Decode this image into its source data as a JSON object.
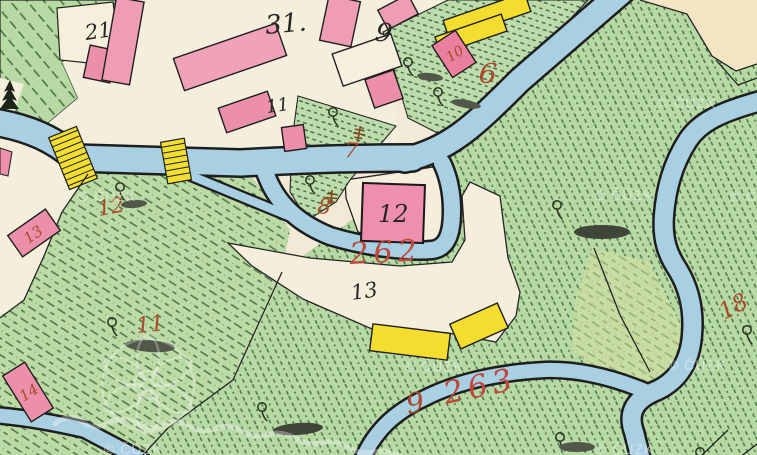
{
  "watermark": {
    "copyright": "© ČÚZK"
  },
  "palette": {
    "paper": "#f2ead6",
    "parcel_white": "#f4eedd",
    "beige_road": "#f3e5c4",
    "meadow_green": "#b7d9a4",
    "hatch_green": "#48744b",
    "water_blue": "#a9cfe2",
    "masonry_pink": "#ef9db5",
    "masonry_bright": "#ee8fae",
    "wood_yellow": "#f4dd2e",
    "ink_black": "#262626",
    "ink_red": "#a8492a",
    "ink_red_script": "#c0463c"
  },
  "labels": {
    "black": {
      "b21": "21",
      "b31": "31.",
      "b9": "9",
      "b11": "11",
      "b12": "12",
      "b13": "13"
    },
    "red": {
      "r6": "6",
      "r7": "7",
      "r8": "8",
      "r9": "9",
      "r10": "10",
      "r11": "11",
      "r12": "12",
      "r13": "13",
      "r14": "14",
      "r18": "18",
      "r262": "262",
      "r263": "263"
    }
  },
  "icons": {
    "tree": "deciduous-tree-icon",
    "conifer": "conifer-icon",
    "marsh": "marsh-tuft-icon",
    "bridge": "hatched-bridge-icon"
  }
}
